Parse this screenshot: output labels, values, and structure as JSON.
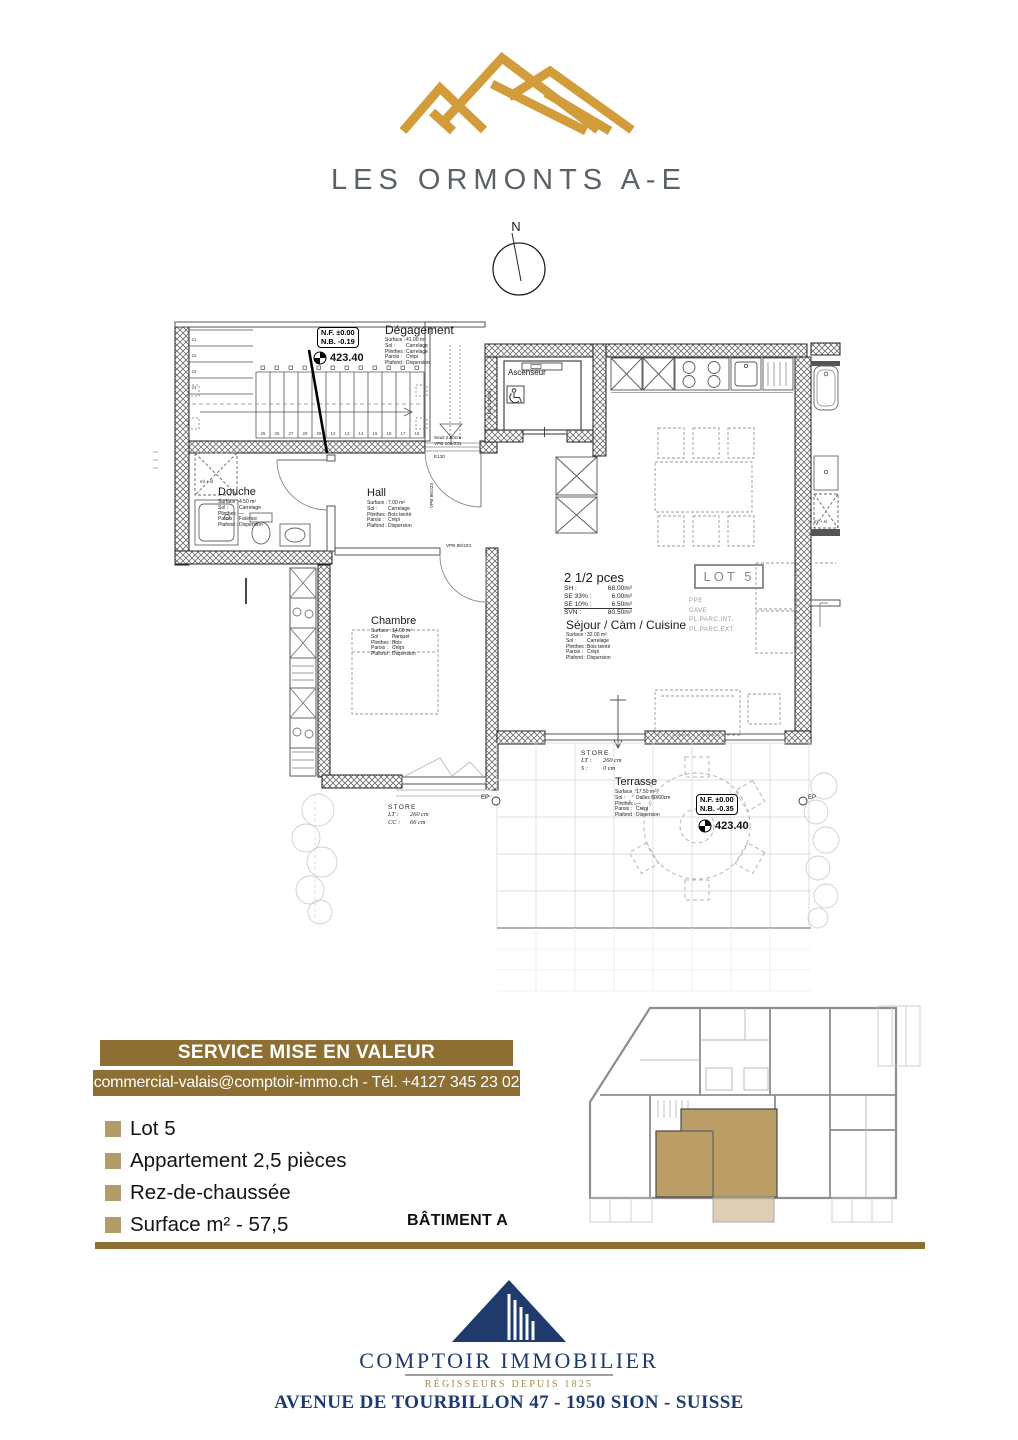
{
  "header": {
    "logo_title": "LES ORMONTS A-E",
    "compass_n": "N",
    "colors": {
      "logo_gold": "#D39C3B",
      "logo_text": "#5A6169"
    }
  },
  "plan": {
    "levels": [
      {
        "nf": "N.F. ±0.00",
        "nb": "N.B. -0.19",
        "alt": "423.40"
      },
      {
        "nf": "N.F. ±0.00",
        "nb": "N.B. -0.35",
        "alt": "423.40"
      }
    ],
    "rooms": {
      "degagement": {
        "name": "Dégagement",
        "specs": [
          [
            "Surface :",
            "41.00 m²"
          ],
          [
            "Sol :",
            "Carrelage"
          ],
          [
            "Plinthes :",
            "Carrelage"
          ],
          [
            "Parois :",
            "Crépi"
          ],
          [
            "Plafond :",
            "Dispersion"
          ]
        ]
      },
      "douche": {
        "name": "Douche",
        "specs": [
          [
            "Surface :",
            "4.50 m²"
          ],
          [
            "Sol :",
            "Carrelage"
          ],
          [
            "Plinthes :",
            "—"
          ],
          [
            "Parois :",
            "Faïence"
          ],
          [
            "Plafond :",
            "Dispersion"
          ]
        ]
      },
      "hall": {
        "name": "Hall",
        "specs": [
          [
            "Surface :",
            "7.00 m²"
          ],
          [
            "Sol :",
            "Carrelage"
          ],
          [
            "Plinthes :",
            "Bois teinté"
          ],
          [
            "Parois :",
            "Crépi"
          ],
          [
            "Plafond :",
            "Dispersion"
          ]
        ]
      },
      "chambre": {
        "name": "Chambre",
        "specs": [
          [
            "Surface :",
            "14.00 m²"
          ],
          [
            "Sol :",
            "Parquet"
          ],
          [
            "Plinthes :",
            "Bois"
          ],
          [
            "Parois :",
            "Crépi"
          ],
          [
            "Plafond :",
            "Dispersion"
          ]
        ]
      },
      "sejour": {
        "name": "Séjour / Càm / Cuisine",
        "specs": [
          [
            "Surface :",
            "32.00 m²"
          ],
          [
            "Sol :",
            "Carrelage"
          ],
          [
            "Plinthes :",
            "Bois teinté"
          ],
          [
            "Parois :",
            "Crépi"
          ],
          [
            "Plafond :",
            "Dispersion"
          ]
        ]
      },
      "terrasse": {
        "name": "Terrasse",
        "specs": [
          [
            "Surface :",
            "17.50 m²"
          ],
          [
            "Sol :",
            "Dalles 60/60cm"
          ],
          [
            "Plinthes :",
            "—"
          ],
          [
            "Parois :",
            "Crépi"
          ],
          [
            "Plafond :",
            "Dispersion"
          ]
        ]
      }
    },
    "stats": {
      "title": "2 1/2 pces",
      "rows": [
        [
          "SH :",
          "68.00m²"
        ],
        [
          "SE 33% :",
          "6.00m²"
        ],
        [
          "SE 10% :",
          "6.50m²"
        ],
        [
          "SVN :",
          "80.50m²"
        ]
      ]
    },
    "lot": {
      "box": "LOT 5",
      "items": [
        "PPE",
        "CAVE",
        "PL.PARC.INT.",
        "PL.PARC.EXT."
      ]
    },
    "labels": {
      "ascenseur": "Ascenseur",
      "s_brut": "S. brut 12.06m",
      "seuil": "Seuil 2.50cm",
      "vpb_door": "VPB 106/231",
      "e130": "E130",
      "vpb_wall": "VPB 86/223",
      "ml_sl": "ml + sl",
      "ep": "EP"
    },
    "stores": [
      {
        "title": "STORE",
        "rows": [
          [
            "LT :",
            "260 cm"
          ],
          [
            "CC :",
            "66 cm"
          ]
        ]
      },
      {
        "title": "STORE",
        "rows": [
          [
            "LT :",
            "260 cm"
          ],
          [
            "S :",
            "0 cm"
          ]
        ]
      }
    ],
    "stairs": {
      "upper": [
        "21",
        "22",
        "23",
        "24"
      ],
      "run": [
        "25",
        "26",
        "27",
        "28",
        "29",
        "12",
        "13",
        "14",
        "15",
        "16",
        "17",
        "18"
      ]
    }
  },
  "footer": {
    "banner_title": "SERVICE MISE EN VALEUR",
    "banner_contact": "commercial-valais@comptoir-immo.ch - Tél. +4127 345 23 02",
    "bullets": [
      "Lot 5",
      "Appartement 2,5 pièces",
      "Rez-de-chaussée",
      "Surface m² - 57,5"
    ],
    "batiment": "BÂTIMENT A",
    "colors": {
      "banner": "#8E6F33",
      "bullet": "#B49B6A",
      "rule": "#8E6F33",
      "highlight": "#B49455"
    }
  },
  "brand": {
    "name": "COMPTOIR IMMOBILIER",
    "tagline": "RÉGISSEURS DEPUIS 1825",
    "address": "AVENUE DE TOURBILLON 47 - 1950 SION - SUISSE",
    "navy": "#1F3B6E",
    "gold": "#A58A50"
  }
}
